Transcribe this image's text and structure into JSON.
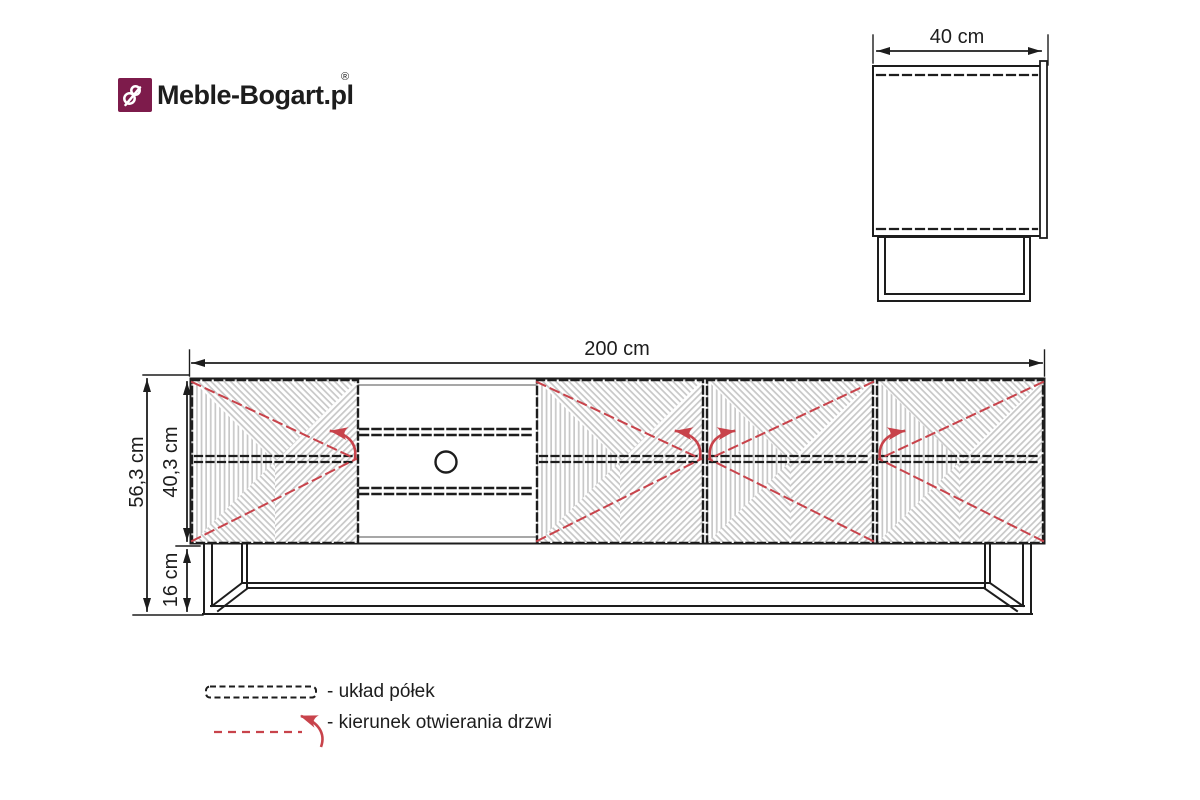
{
  "brand": {
    "name": "Meble-Bogart.pl",
    "registered": "®"
  },
  "views": {
    "side": {
      "depth_label": "40 cm"
    },
    "front": {
      "width_label": "200 cm",
      "total_height_label": "56,3 cm",
      "body_height_label": "40,3 cm",
      "leg_height_label": "16 cm",
      "doors": [
        {
          "id": "door-1",
          "opening_arrow": "left"
        },
        {
          "id": "door-2",
          "opening_arrow": "left"
        },
        {
          "id": "door-3",
          "opening_arrow": "right"
        },
        {
          "id": "door-4",
          "opening_arrow": "right"
        }
      ]
    }
  },
  "legend": {
    "shelf_label": "- układ półek",
    "door_label": "- kierunek otwierania drzwi"
  },
  "colors": {
    "line": "#1d1d1d",
    "red": "#c8434b",
    "stripe": "#c8c8c8",
    "logo": "#7d1b4b"
  }
}
